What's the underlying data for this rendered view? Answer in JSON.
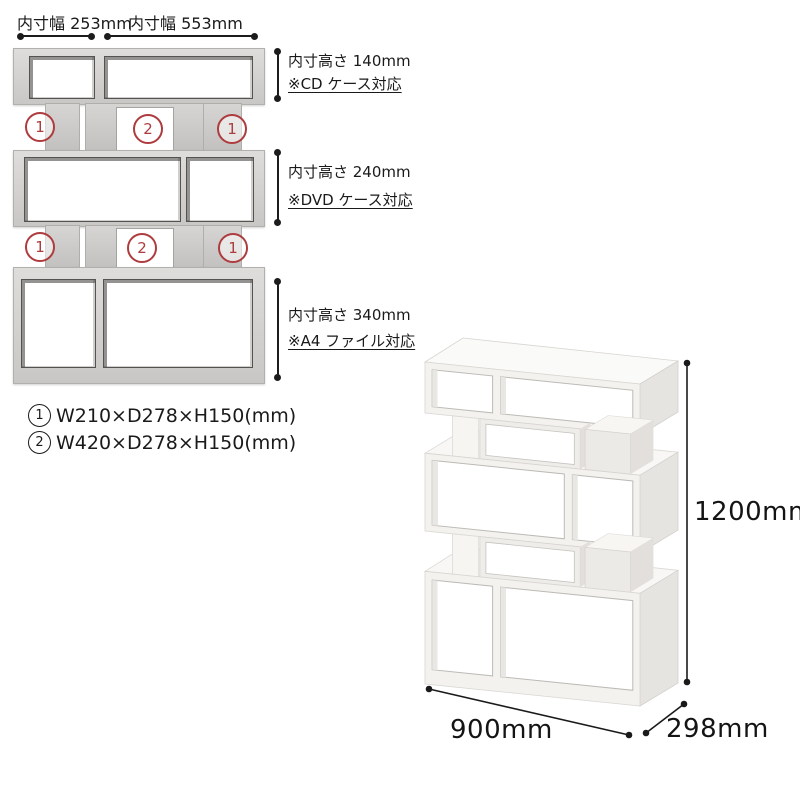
{
  "colors": {
    "marker_red": "#ae3c3e",
    "line_black": "#1c1c1c",
    "wood_gray": "#d6d5d3",
    "wood_white": "#f3f2ef"
  },
  "front_view": {
    "width_dims": [
      {
        "label": "内寸幅 253mm"
      },
      {
        "label": "内寸幅 553mm"
      }
    ],
    "height_dims": [
      {
        "label": "内寸高さ 140mm",
        "note": "※CD ケース対応"
      },
      {
        "label": "内寸高さ 240mm",
        "note": "※DVD ケース対応"
      },
      {
        "label": "内寸高さ 340mm",
        "note": "※A4 ファイル対応"
      }
    ],
    "markers": {
      "row1": [
        "1",
        "2",
        "1"
      ],
      "row2": [
        "1",
        "2",
        "1"
      ]
    }
  },
  "specs": [
    {
      "marker": "1",
      "text": "W210×D278×H150(mm)"
    },
    {
      "marker": "2",
      "text": "W420×D278×H150(mm)"
    }
  ],
  "product_view": {
    "height": "1200mm",
    "width": "900mm",
    "depth": "298mm"
  }
}
